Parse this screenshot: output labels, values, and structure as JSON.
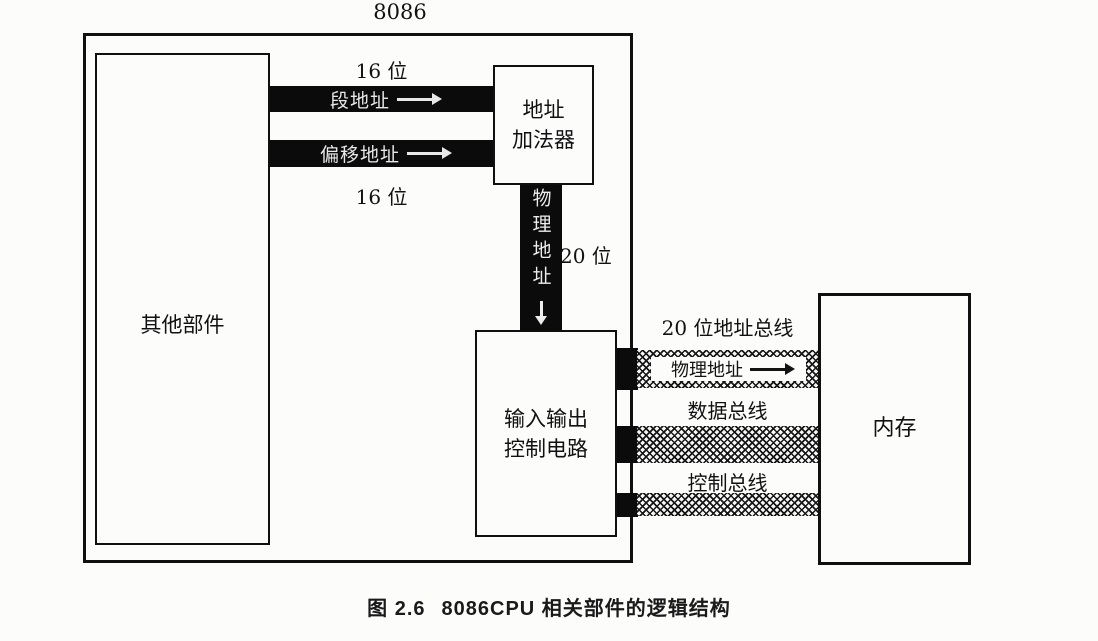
{
  "labels": {
    "chip": "8086",
    "bit16_top": "16 位",
    "bit16_bottom": "16 位",
    "bit20": "20 位"
  },
  "boxes": {
    "other": "其他部件",
    "adder_line1": "地址",
    "adder_line2": "加法器",
    "io_line1": "输入输出",
    "io_line2": "控制电路",
    "memory": "内存"
  },
  "arrows": {
    "segment": "段地址",
    "offset": "偏移地址",
    "physical_vertical": "物理地址"
  },
  "buses": {
    "address_title": "20 位地址总线",
    "address_inner": "物理地址",
    "data_title": "数据总线",
    "control_title": "控制总线"
  },
  "caption": {
    "number": "图 2.6",
    "title": "8086CPU 相关部件的逻辑结构"
  },
  "colors": {
    "ink": "#111111",
    "paper": "#fcfcfb"
  }
}
